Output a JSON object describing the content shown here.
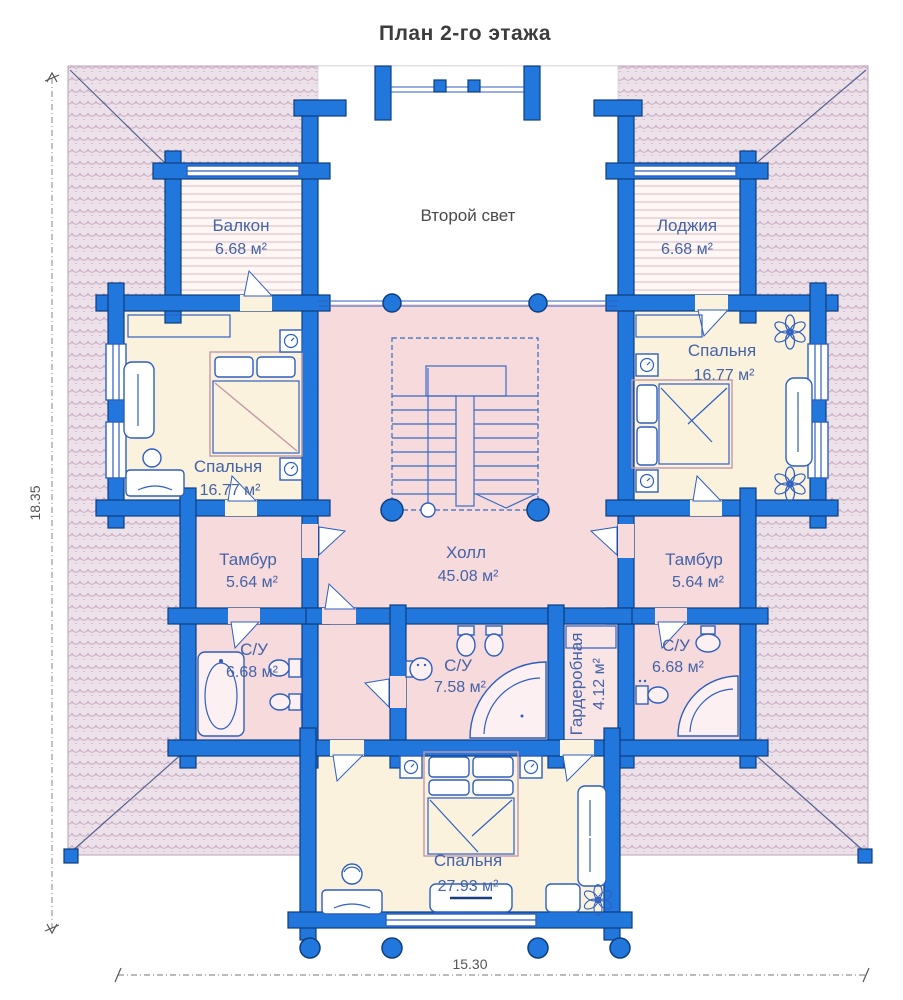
{
  "title": "План 2-го этажа",
  "dimensions": {
    "height": "18.35",
    "width": "15.30"
  },
  "rooms": {
    "balcony": {
      "name": "Балкон",
      "area": "6.68 м²"
    },
    "second_light": {
      "name": "Второй свет"
    },
    "loggia": {
      "name": "Лоджия",
      "area": "6.68 м²"
    },
    "bedroom_left": {
      "name": "Спальня",
      "area": "16.77 м²"
    },
    "bedroom_right": {
      "name": "Спальня",
      "area": "16.77 м²"
    },
    "hall": {
      "name": "Холл",
      "area": "45.08 м²"
    },
    "tambour_left": {
      "name": "Тамбур",
      "area": "5.64 м²"
    },
    "tambour_right": {
      "name": "Тамбур",
      "area": "5.64 м²"
    },
    "su_left": {
      "name": "С/У",
      "area": "6.68 м²"
    },
    "su_center": {
      "name": "С/У",
      "area": "7.58 м²"
    },
    "wardrobe": {
      "name": "Гардеробная",
      "area": "4.12 м²"
    },
    "su_right": {
      "name": "С/У",
      "area": "6.68 м²"
    },
    "bedroom_bottom": {
      "name": "Спальня",
      "area": "27.93 м²"
    }
  },
  "colors": {
    "wall_blue": "#2277dd",
    "wall_outline": "#0d3e7e",
    "roof_fill": "#ece1e9",
    "roof_pattern": "#c9a6c2",
    "bedroom_floor": "#faf2dc",
    "hall_floor": "#f7dadb",
    "label_text": "#4563a8"
  }
}
